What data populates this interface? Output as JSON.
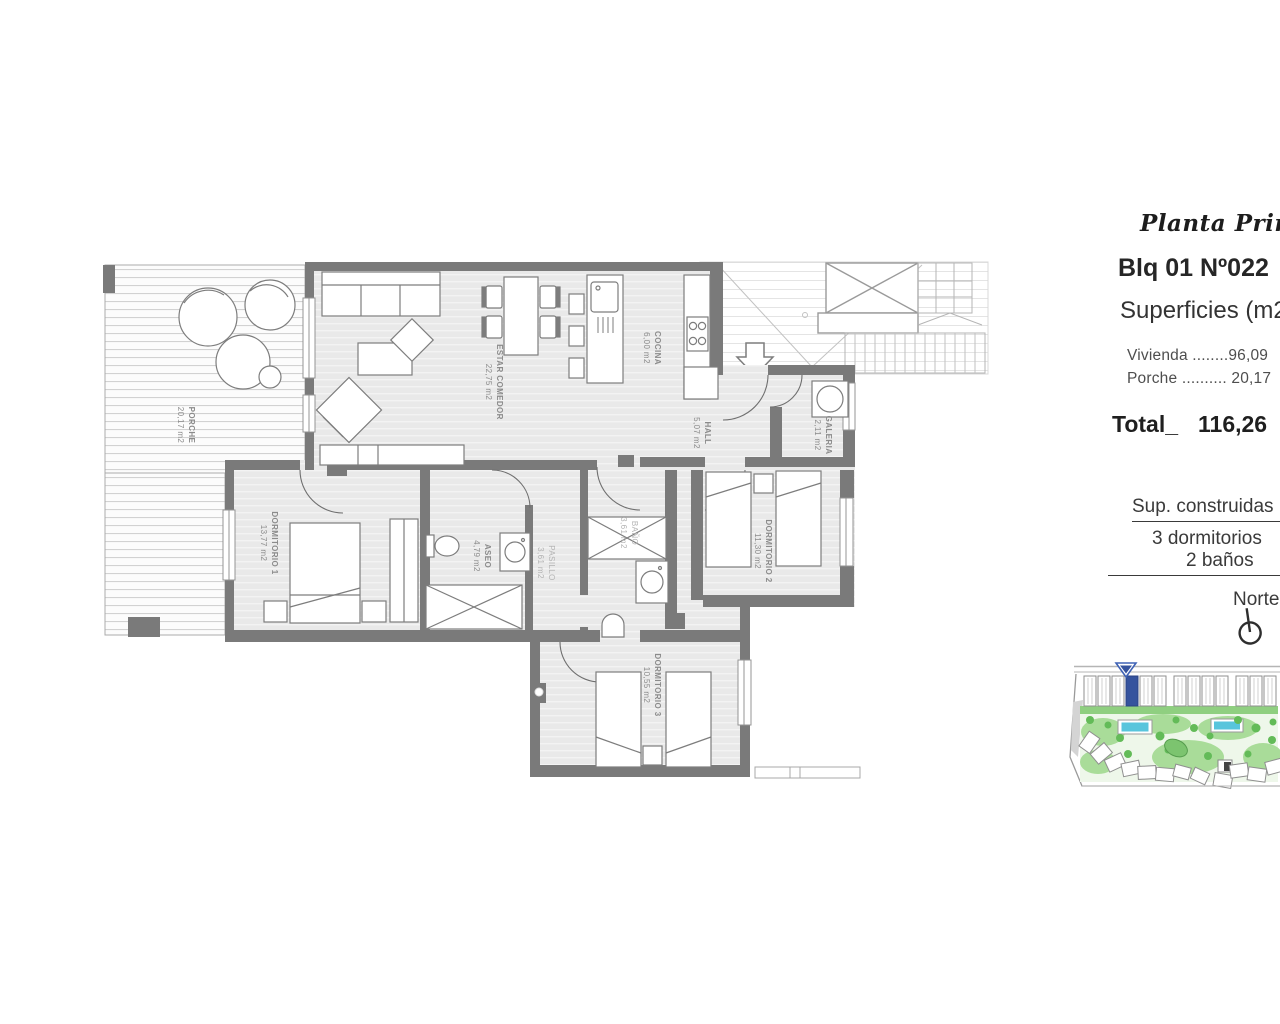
{
  "panel": {
    "title": "Planta Primera",
    "block": "Blq 01",
    "unit": "Nº022",
    "surfaces_heading": "Superficies (m2)",
    "surface_rows": [
      "Vivienda ........96,09",
      "Porche .......... 20,17"
    ],
    "total_label": "Total_",
    "total_value": "116,26",
    "built_heading": "Sup. construidas",
    "bedrooms": "3 dormitorios",
    "baths": "2 baños",
    "north_label": "Norte"
  },
  "plan": {
    "rooms": [
      {
        "name": "PORCHE",
        "area": "20,17 m2"
      },
      {
        "name": "ESTAR COMEDOR",
        "area": "22,75 m2"
      },
      {
        "name": "COCINA",
        "area": "6,00 m2"
      },
      {
        "name": "HALL",
        "area": "5,07 m2"
      },
      {
        "name": "GALERIA",
        "area": "2,11 m2"
      },
      {
        "name": "DORMITORIO 1",
        "area": "13,77 m2"
      },
      {
        "name": "ASEO",
        "area": "4,79 m2"
      },
      {
        "name": "PASILLO",
        "area": "3,61 m2"
      },
      {
        "name": "BAÑO",
        "area": "3,61 m2"
      },
      {
        "name": "DORMITORIO 2",
        "area": "11,30 m2"
      },
      {
        "name": "DORMITORIO 3",
        "area": "10,55 m2"
      }
    ]
  },
  "colors": {
    "wall": "#7a7a7a",
    "floor": "#e9e9e9",
    "highlight_blue": "#35539e",
    "pool_blue": "#58c5dc",
    "lawn_green": "#a9dc99"
  }
}
